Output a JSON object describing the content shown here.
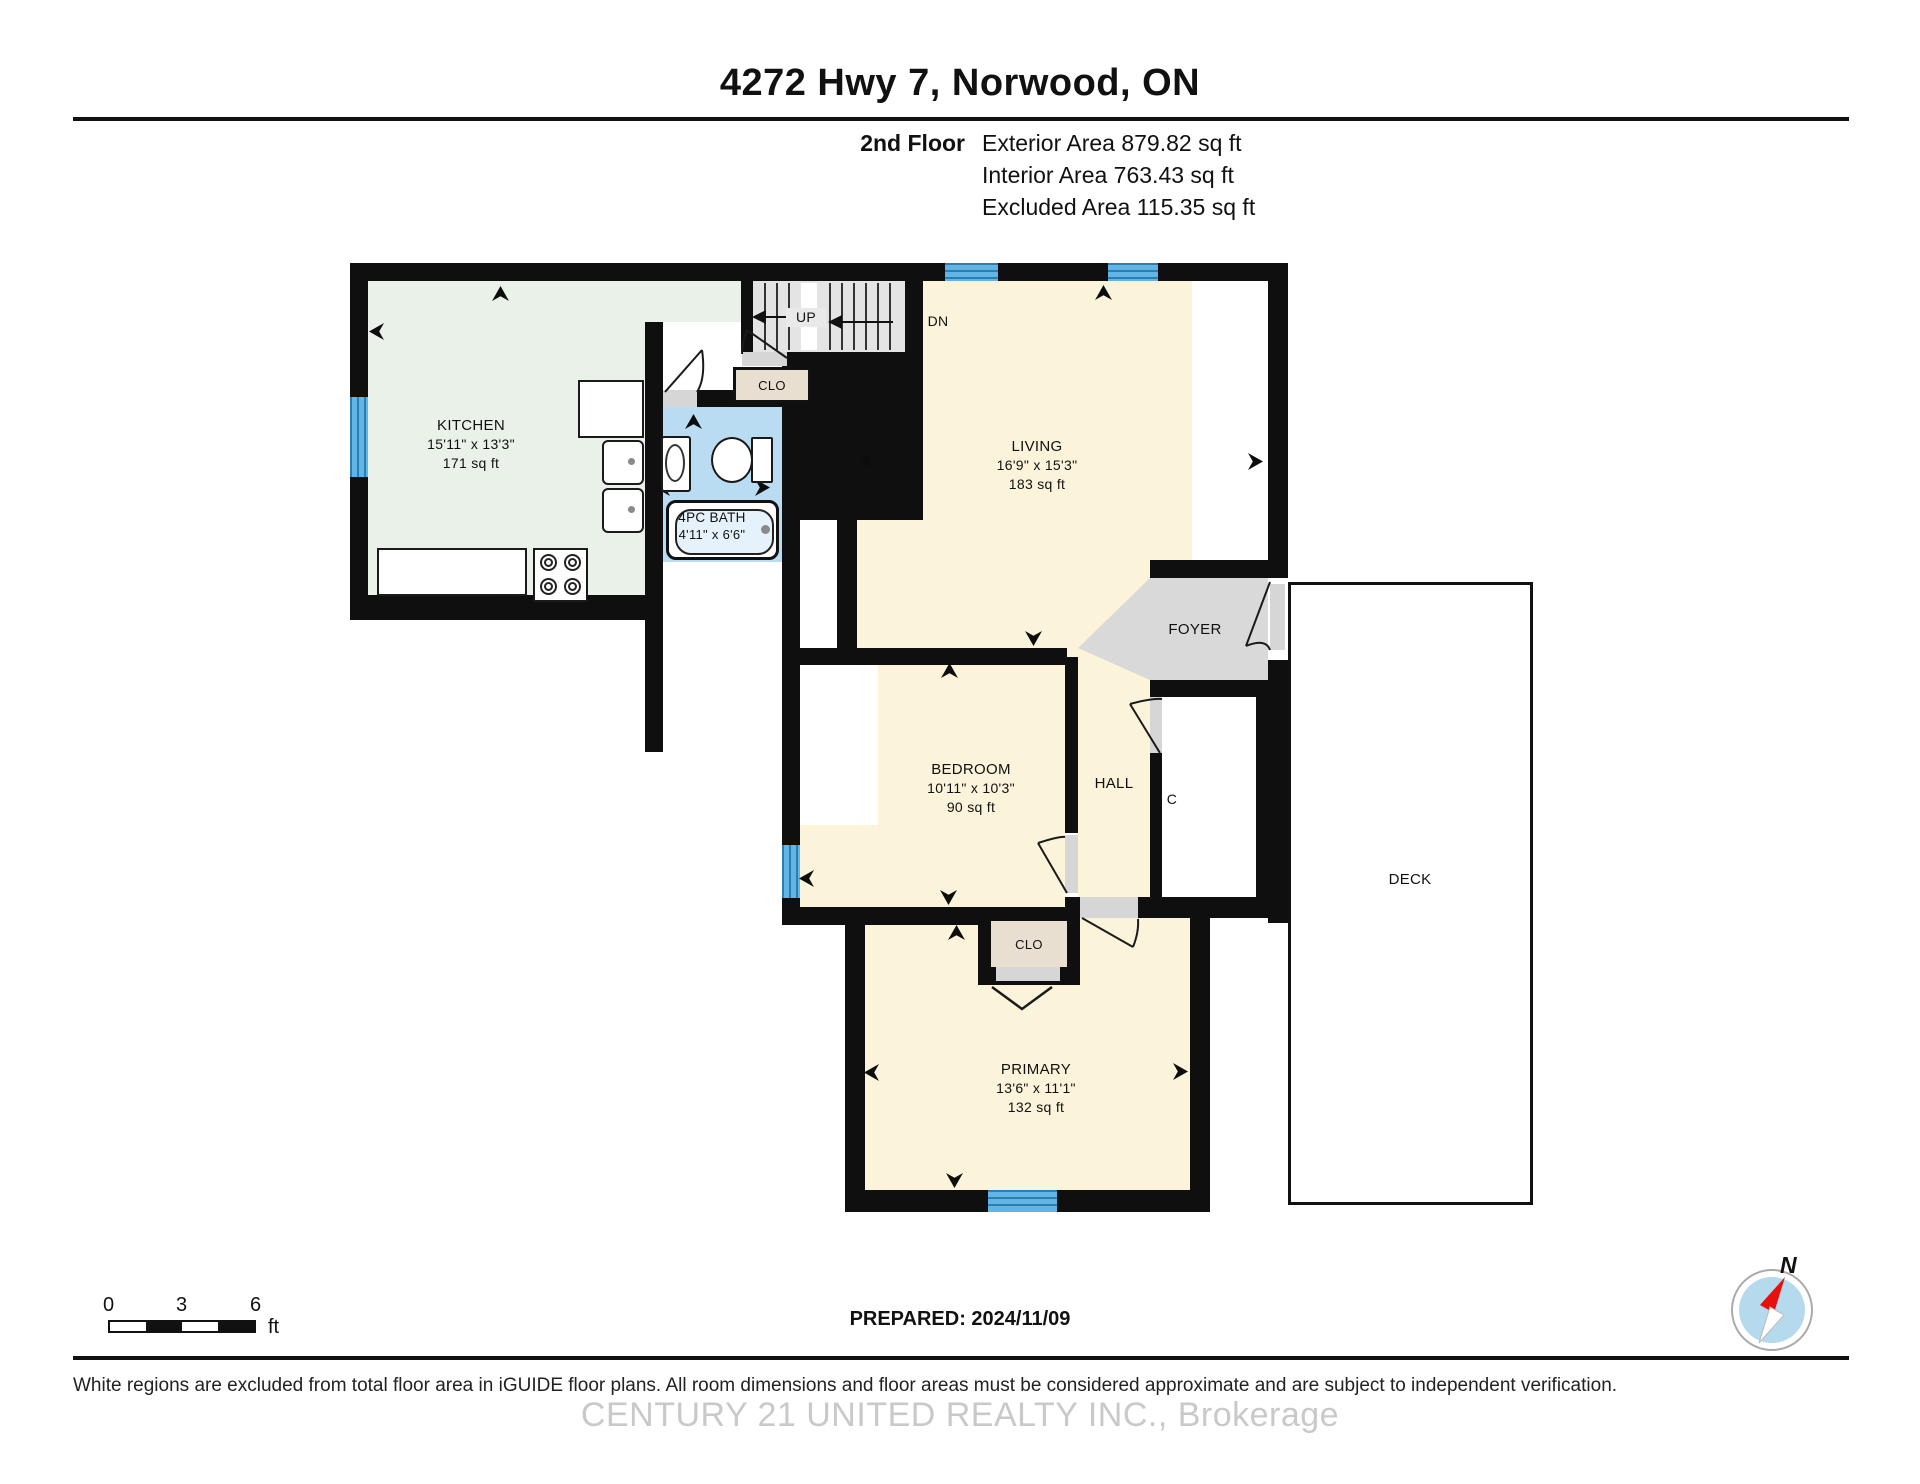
{
  "header": {
    "title": "4272 Hwy 7, Norwood, ON",
    "floor_label": "2nd Floor",
    "exterior_area": "Exterior Area 879.82 sq ft",
    "interior_area": "Interior Area 763.43 sq ft",
    "excluded_area": "Excluded Area 115.35 sq ft"
  },
  "rooms": {
    "kitchen": {
      "name": "KITCHEN",
      "dims": "15'11\" x 13'3\"",
      "area": "171 sq ft"
    },
    "living": {
      "name": "LIVING",
      "dims": "16'9\" x 15'3\"",
      "area": "183 sq ft"
    },
    "bath": {
      "name": "4PC BATH",
      "dims": "4'11\" x 6'6\""
    },
    "bedroom": {
      "name": "BEDROOM",
      "dims": "10'11\" x 10'3\"",
      "area": "90 sq ft"
    },
    "primary": {
      "name": "PRIMARY",
      "dims": "13'6\" x 11'1\"",
      "area": "132 sq ft"
    },
    "foyer": {
      "name": "FOYER"
    },
    "hall": {
      "name": "HALL"
    },
    "closet_c": {
      "name": "C"
    },
    "closet_upper": {
      "name": "CLO"
    },
    "closet_lower": {
      "name": "CLO"
    },
    "deck": {
      "name": "DECK"
    }
  },
  "stairs": {
    "up_label": "UP",
    "down_label": "DN"
  },
  "scale_bar": {
    "tick_0": "0",
    "tick_3": "3",
    "tick_6": "6",
    "unit": "ft"
  },
  "prepared_label": "PREPARED: 2024/11/09",
  "compass": {
    "north_label": "N"
  },
  "footer": {
    "disclaimer": "White regions are excluded from total floor area in iGUIDE floor plans. All room dimensions and floor areas must be considered approximate and are subject to independent verification.",
    "watermark": "CENTURY 21 UNITED REALTY INC., Brokerage"
  },
  "colors": {
    "wall": "#0f0f0f",
    "room_cream": "#fbf3da",
    "kitchen_green": "#e9f1e9",
    "bath_blue": "#badcf2",
    "window_blue": "#56a9da",
    "closet_beige": "#e9dfd0",
    "foyer_gray": "#d9d9d9",
    "stairs_gray": "#e4e4e4",
    "deck_white": "#ffffff"
  }
}
